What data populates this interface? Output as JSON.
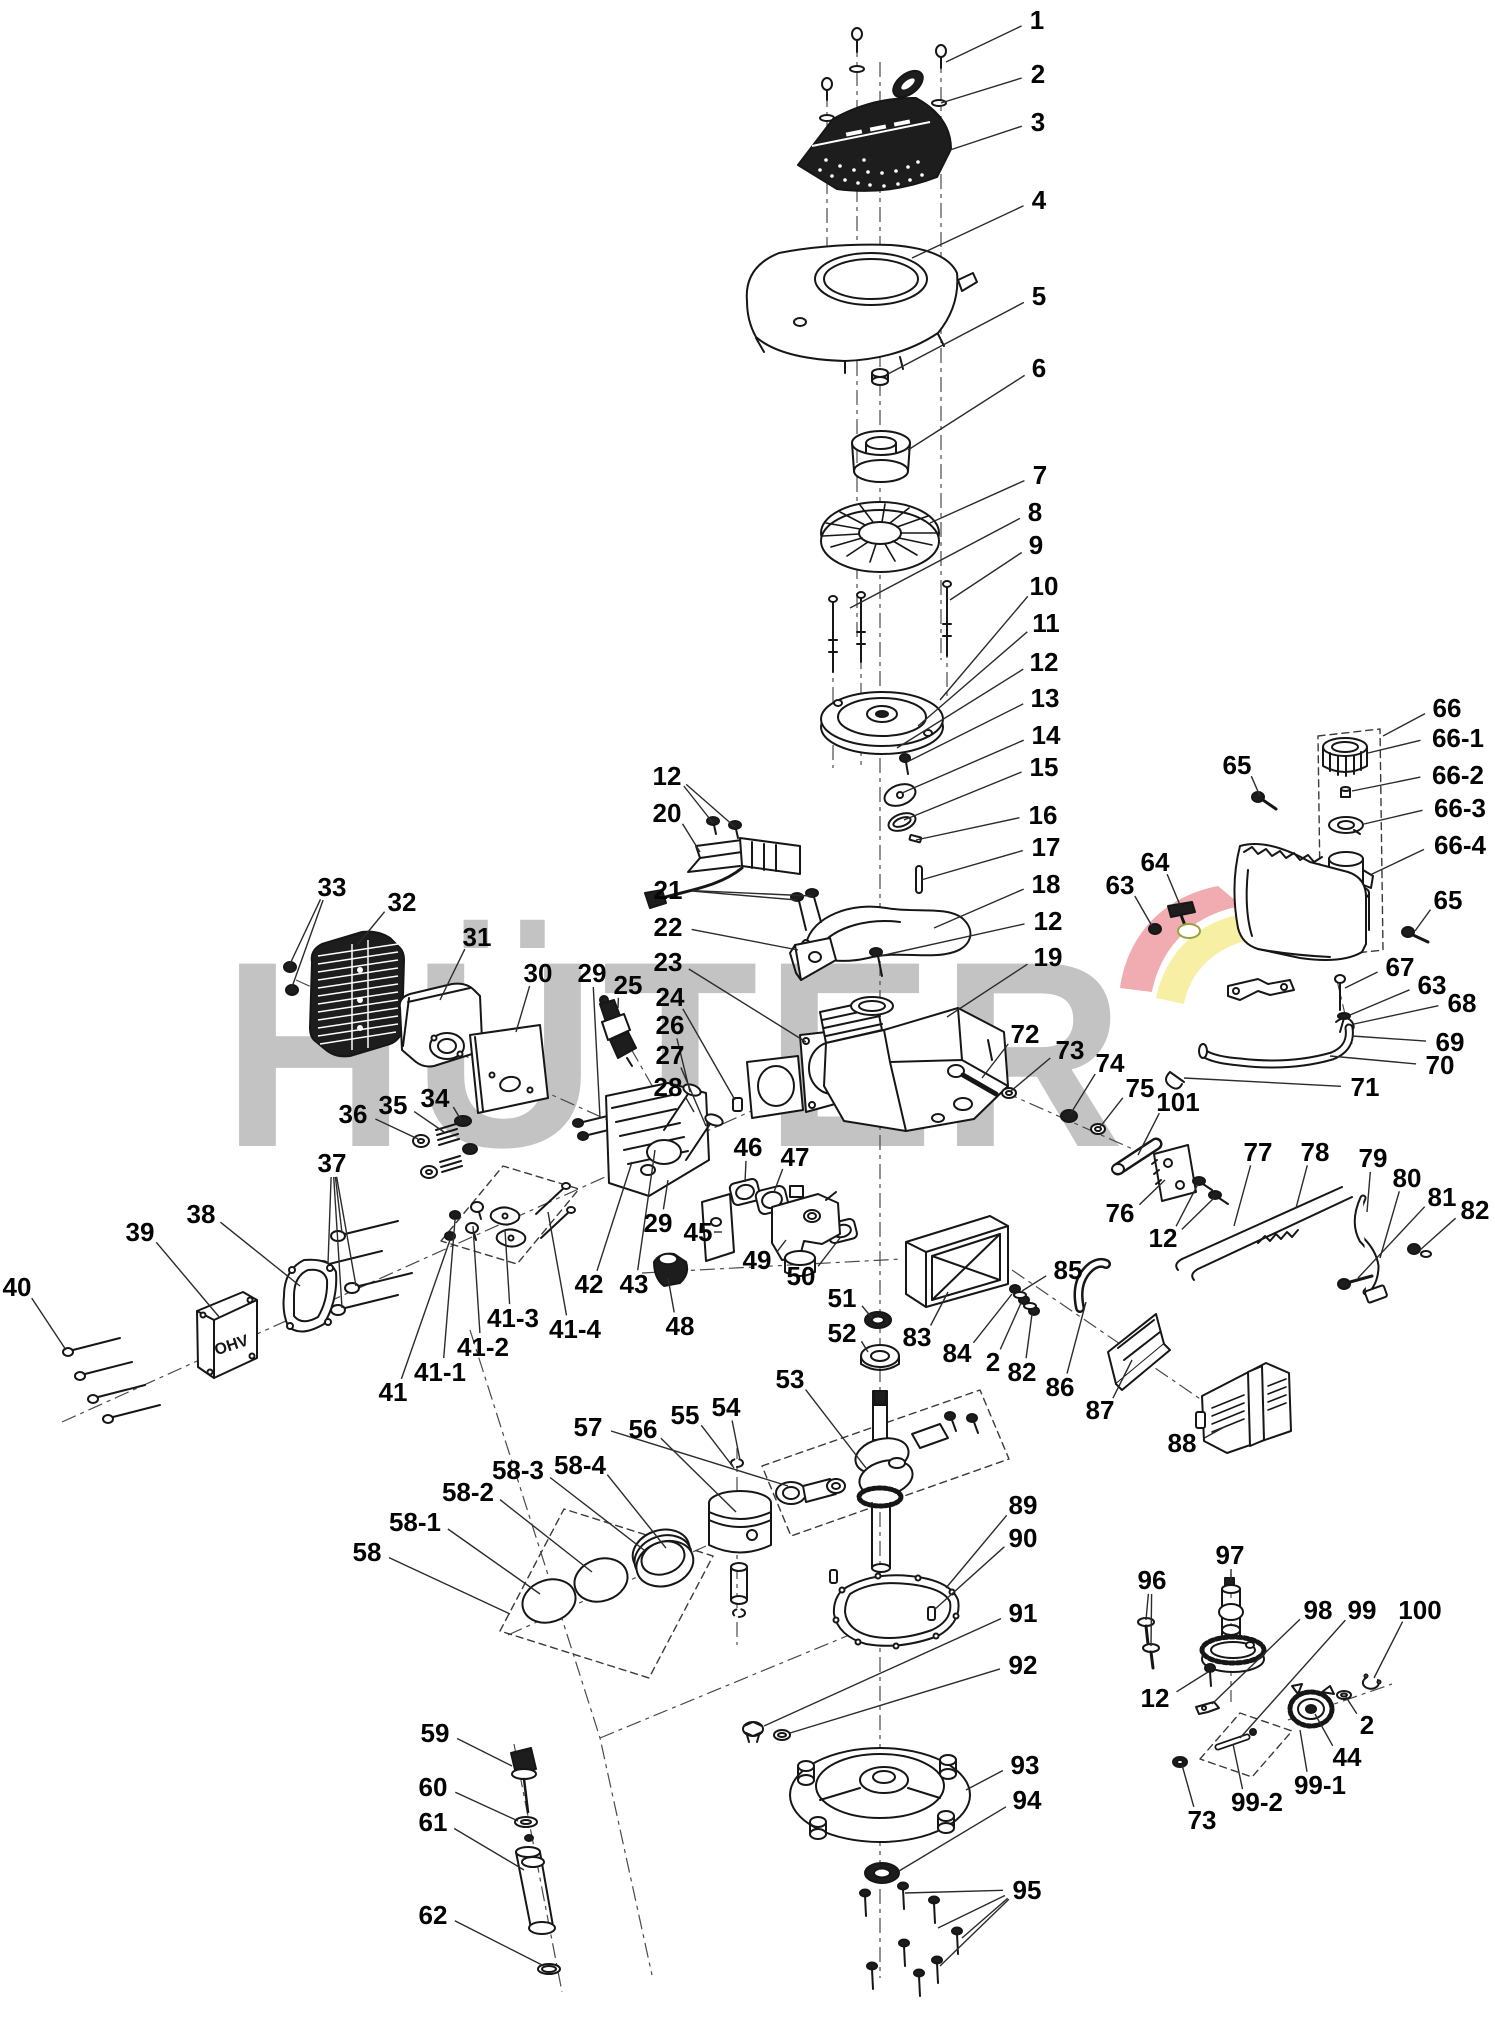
{
  "watermark": {
    "text": "HÜTER",
    "color": "#c3c3c3",
    "arc_pink": "#f0acb0",
    "arc_yellow": "#f7f0a4",
    "cover_text": "OHV"
  },
  "labels": [
    {
      "t": "1",
      "x": 1037,
      "y": 20,
      "g": [
        [
          946,
          62
        ]
      ]
    },
    {
      "t": "2",
      "x": 1038,
      "y": 74,
      "g": [
        [
          941,
          103
        ]
      ]
    },
    {
      "t": "3",
      "x": 1038,
      "y": 122,
      "g": [
        [
          950,
          150
        ]
      ]
    },
    {
      "t": "4",
      "x": 1039,
      "y": 200,
      "g": [
        [
          912,
          258
        ]
      ]
    },
    {
      "t": "5",
      "x": 1039,
      "y": 296,
      "g": [
        [
          888,
          374
        ]
      ]
    },
    {
      "t": "6",
      "x": 1039,
      "y": 368,
      "g": [
        [
          908,
          450
        ]
      ]
    },
    {
      "t": "7",
      "x": 1040,
      "y": 475,
      "g": [
        [
          930,
          523
        ]
      ]
    },
    {
      "t": "8",
      "x": 1035,
      "y": 512,
      "g": [
        [
          850,
          608
        ]
      ]
    },
    {
      "t": "9",
      "x": 1036,
      "y": 545,
      "g": [
        [
          950,
          600
        ]
      ]
    },
    {
      "t": "10",
      "x": 1044,
      "y": 586,
      "g": [
        [
          940,
          700
        ]
      ]
    },
    {
      "t": "11",
      "x": 1046,
      "y": 623,
      "g": [
        [
          918,
          726
        ]
      ]
    },
    {
      "t": "12",
      "x": 1044,
      "y": 662,
      "g": [
        [
          897,
          748
        ]
      ]
    },
    {
      "t": "13",
      "x": 1045,
      "y": 698,
      "g": [
        [
          907,
          762
        ]
      ]
    },
    {
      "t": "14",
      "x": 1046,
      "y": 735,
      "g": [
        [
          902,
          793
        ]
      ]
    },
    {
      "t": "15",
      "x": 1044,
      "y": 767,
      "g": [
        [
          904,
          820
        ]
      ]
    },
    {
      "t": "16",
      "x": 1043,
      "y": 815,
      "g": [
        [
          916,
          840
        ]
      ]
    },
    {
      "t": "17",
      "x": 1046,
      "y": 847,
      "g": [
        [
          921,
          880
        ]
      ]
    },
    {
      "t": "18",
      "x": 1046,
      "y": 884,
      "g": [
        [
          934,
          928
        ]
      ]
    },
    {
      "t": "12",
      "x": 1048,
      "y": 921,
      "g": [
        [
          880,
          956
        ]
      ]
    },
    {
      "t": "19",
      "x": 1048,
      "y": 957,
      "g": [
        [
          947,
          1017
        ]
      ]
    },
    {
      "t": "12",
      "x": 667,
      "y": 776,
      "g": [
        [
          713,
          823
        ],
        [
          735,
          827
        ]
      ]
    },
    {
      "t": "20",
      "x": 667,
      "y": 813,
      "g": [
        [
          700,
          852
        ]
      ]
    },
    {
      "t": "21",
      "x": 668,
      "y": 890,
      "g": [
        [
          797,
          900
        ],
        [
          812,
          896
        ]
      ]
    },
    {
      "t": "22",
      "x": 668,
      "y": 927,
      "g": [
        [
          798,
          950
        ]
      ]
    },
    {
      "t": "23",
      "x": 668,
      "y": 962,
      "g": [
        [
          806,
          1042
        ]
      ]
    },
    {
      "t": "24",
      "x": 670,
      "y": 997,
      "g": [
        [
          735,
          1100
        ]
      ]
    },
    {
      "t": "26",
      "x": 670,
      "y": 1025,
      "g": [
        [
          690,
          1092
        ]
      ]
    },
    {
      "t": "27",
      "x": 670,
      "y": 1055,
      "g": [
        [
          706,
          1126
        ]
      ]
    },
    {
      "t": "28",
      "x": 668,
      "y": 1087,
      "g": [
        [
          694,
          1112
        ]
      ]
    },
    {
      "t": "33",
      "x": 332,
      "y": 887,
      "g": [
        [
          290,
          964
        ],
        [
          292,
          987
        ]
      ]
    },
    {
      "t": "32",
      "x": 402,
      "y": 902,
      "g": [
        [
          358,
          944
        ]
      ]
    },
    {
      "t": "31",
      "x": 477,
      "y": 937,
      "g": [
        [
          440,
          1000
        ]
      ]
    },
    {
      "t": "30",
      "x": 538,
      "y": 973,
      "g": [
        [
          516,
          1032
        ]
      ]
    },
    {
      "t": "29",
      "x": 592,
      "y": 973,
      "g": [
        [
          600,
          1118
        ]
      ]
    },
    {
      "t": "25",
      "x": 628,
      "y": 985,
      "g": [
        [
          618,
          1008
        ]
      ]
    },
    {
      "t": "36",
      "x": 353,
      "y": 1114,
      "g": [
        [
          418,
          1139
        ]
      ]
    },
    {
      "t": "35",
      "x": 393,
      "y": 1105,
      "g": [
        [
          444,
          1132
        ]
      ]
    },
    {
      "t": "34",
      "x": 435,
      "y": 1098,
      "g": [
        [
          461,
          1120
        ]
      ]
    },
    {
      "t": "37",
      "x": 332,
      "y": 1163,
      "g": [
        [
          342,
          1233
        ],
        [
          328,
          1264
        ],
        [
          356,
          1286
        ],
        [
          342,
          1308
        ]
      ]
    },
    {
      "t": "38",
      "x": 201,
      "y": 1214,
      "g": [
        [
          300,
          1286
        ]
      ]
    },
    {
      "t": "39",
      "x": 140,
      "y": 1232,
      "g": [
        [
          220,
          1318
        ]
      ]
    },
    {
      "t": "40",
      "x": 17,
      "y": 1287,
      "g": [
        [
          66,
          1350
        ]
      ]
    },
    {
      "t": "41",
      "x": 393,
      "y": 1392,
      "g": [
        [
          450,
          1240
        ]
      ]
    },
    {
      "t": "41-1",
      "x": 440,
      "y": 1372,
      "g": [
        [
          455,
          1220
        ]
      ]
    },
    {
      "t": "41-2",
      "x": 483,
      "y": 1347,
      "g": [
        [
          473,
          1226
        ]
      ]
    },
    {
      "t": "41-3",
      "x": 513,
      "y": 1318,
      "g": [
        [
          505,
          1230
        ]
      ]
    },
    {
      "t": "41-4",
      "x": 575,
      "y": 1329,
      "g": [
        [
          548,
          1212
        ]
      ]
    },
    {
      "t": "42",
      "x": 589,
      "y": 1284,
      "g": [
        [
          632,
          1162
        ]
      ]
    },
    {
      "t": "43",
      "x": 634,
      "y": 1284,
      "g": [
        [
          655,
          1150
        ]
      ]
    },
    {
      "t": "29",
      "x": 658,
      "y": 1223,
      "g": [
        [
          668,
          1180
        ]
      ]
    },
    {
      "t": "45",
      "x": 698,
      "y": 1232,
      "g": [
        [
          714,
          1232
        ]
      ]
    },
    {
      "t": "46",
      "x": 748,
      "y": 1147,
      "g": [
        [
          745,
          1182
        ]
      ]
    },
    {
      "t": "47",
      "x": 795,
      "y": 1157,
      "g": [
        [
          774,
          1192
        ]
      ]
    },
    {
      "t": "48",
      "x": 680,
      "y": 1326,
      "g": [
        [
          668,
          1278
        ]
      ]
    },
    {
      "t": "49",
      "x": 757,
      "y": 1260,
      "g": [
        [
          786,
          1240
        ]
      ]
    },
    {
      "t": "50",
      "x": 801,
      "y": 1276,
      "g": [
        [
          840,
          1238
        ]
      ]
    },
    {
      "t": "51",
      "x": 842,
      "y": 1298,
      "g": [
        [
          872,
          1318
        ]
      ]
    },
    {
      "t": "52",
      "x": 842,
      "y": 1333,
      "g": [
        [
          868,
          1352
        ]
      ]
    },
    {
      "t": "53",
      "x": 790,
      "y": 1379,
      "g": [
        [
          866,
          1468
        ]
      ]
    },
    {
      "t": "83",
      "x": 917,
      "y": 1337,
      "g": [
        [
          948,
          1292
        ]
      ]
    },
    {
      "t": "84",
      "x": 957,
      "y": 1353,
      "g": [
        [
          1012,
          1294
        ]
      ]
    },
    {
      "t": "2",
      "x": 993,
      "y": 1362,
      "g": [
        [
          1021,
          1303
        ]
      ]
    },
    {
      "t": "82",
      "x": 1022,
      "y": 1372,
      "g": [
        [
          1032,
          1314
        ]
      ]
    },
    {
      "t": "85",
      "x": 1068,
      "y": 1270,
      "g": [
        [
          1022,
          1291
        ]
      ]
    },
    {
      "t": "86",
      "x": 1060,
      "y": 1387,
      "g": [
        [
          1086,
          1302
        ]
      ]
    },
    {
      "t": "87",
      "x": 1100,
      "y": 1410,
      "g": [
        [
          1132,
          1360
        ]
      ]
    },
    {
      "t": "88",
      "x": 1182,
      "y": 1443,
      "g": [
        [
          1226,
          1426
        ]
      ]
    },
    {
      "t": "72",
      "x": 1025,
      "y": 1034,
      "g": [
        [
          982,
          1078
        ]
      ]
    },
    {
      "t": "73",
      "x": 1070,
      "y": 1050,
      "g": [
        [
          1011,
          1091
        ]
      ]
    },
    {
      "t": "74",
      "x": 1110,
      "y": 1063,
      "g": [
        [
          1071,
          1113
        ]
      ]
    },
    {
      "t": "75",
      "x": 1140,
      "y": 1088,
      "g": [
        [
          1100,
          1127
        ]
      ]
    },
    {
      "t": "101",
      "x": 1178,
      "y": 1102,
      "g": [
        [
          1138,
          1155
        ]
      ]
    },
    {
      "t": "76",
      "x": 1120,
      "y": 1213,
      "g": [
        [
          1165,
          1180
        ]
      ]
    },
    {
      "t": "12",
      "x": 1163,
      "y": 1238,
      "g": [
        [
          1198,
          1184
        ],
        [
          1214,
          1198
        ]
      ]
    },
    {
      "t": "77",
      "x": 1258,
      "y": 1152,
      "g": [
        [
          1234,
          1226
        ]
      ]
    },
    {
      "t": "78",
      "x": 1315,
      "y": 1152,
      "g": [
        [
          1296,
          1208
        ]
      ]
    },
    {
      "t": "79",
      "x": 1373,
      "y": 1158,
      "g": [
        [
          1367,
          1212
        ]
      ]
    },
    {
      "t": "80",
      "x": 1407,
      "y": 1178,
      "g": [
        [
          1380,
          1258
        ]
      ]
    },
    {
      "t": "81",
      "x": 1442,
      "y": 1197,
      "g": [
        [
          1358,
          1278
        ]
      ]
    },
    {
      "t": "82",
      "x": 1475,
      "y": 1210,
      "g": [
        [
          1420,
          1250
        ]
      ]
    },
    {
      "t": "63",
      "x": 1120,
      "y": 885,
      "g": [
        [
          1152,
          926
        ]
      ]
    },
    {
      "t": "64",
      "x": 1155,
      "y": 862,
      "g": [
        [
          1180,
          905
        ]
      ]
    },
    {
      "t": "65",
      "x": 1237,
      "y": 765,
      "g": [
        [
          1260,
          796
        ]
      ]
    },
    {
      "t": "66",
      "x": 1447,
      "y": 708,
      "g": [
        [
          1383,
          736
        ]
      ]
    },
    {
      "t": "66-1",
      "x": 1458,
      "y": 738,
      "g": [
        [
          1368,
          753
        ]
      ]
    },
    {
      "t": "66-2",
      "x": 1458,
      "y": 775,
      "g": [
        [
          1352,
          791
        ]
      ]
    },
    {
      "t": "66-3",
      "x": 1460,
      "y": 808,
      "g": [
        [
          1364,
          824
        ]
      ]
    },
    {
      "t": "66-4",
      "x": 1460,
      "y": 845,
      "g": [
        [
          1370,
          875
        ]
      ]
    },
    {
      "t": "65",
      "x": 1448,
      "y": 900,
      "g": [
        [
          1415,
          931
        ]
      ]
    },
    {
      "t": "67",
      "x": 1400,
      "y": 967,
      "g": [
        [
          1345,
          988
        ]
      ]
    },
    {
      "t": "63",
      "x": 1432,
      "y": 985,
      "g": [
        [
          1350,
          1015
        ]
      ]
    },
    {
      "t": "68",
      "x": 1462,
      "y": 1003,
      "g": [
        [
          1354,
          1024
        ]
      ]
    },
    {
      "t": "69",
      "x": 1450,
      "y": 1042,
      "g": [
        [
          1352,
          1036
        ]
      ]
    },
    {
      "t": "70",
      "x": 1440,
      "y": 1065,
      "g": [
        [
          1330,
          1056
        ]
      ]
    },
    {
      "t": "71",
      "x": 1365,
      "y": 1087,
      "g": [
        [
          1184,
          1078
        ]
      ]
    },
    {
      "t": "89",
      "x": 1023,
      "y": 1505,
      "g": [
        [
          946,
          1588
        ]
      ]
    },
    {
      "t": "90",
      "x": 1023,
      "y": 1538,
      "g": [
        [
          934,
          1610
        ]
      ]
    },
    {
      "t": "91",
      "x": 1023,
      "y": 1613,
      "g": [
        [
          764,
          1726
        ]
      ]
    },
    {
      "t": "92",
      "x": 1023,
      "y": 1665,
      "g": [
        [
          790,
          1733
        ]
      ]
    },
    {
      "t": "93",
      "x": 1025,
      "y": 1765,
      "g": [
        [
          966,
          1790
        ]
      ]
    },
    {
      "t": "94",
      "x": 1027,
      "y": 1800,
      "g": [
        [
          899,
          1871
        ]
      ]
    },
    {
      "t": "95",
      "x": 1027,
      "y": 1890,
      "g": [
        [
          905,
          1893
        ],
        [
          938,
          1928
        ],
        [
          962,
          1938
        ],
        [
          940,
          1966
        ]
      ]
    },
    {
      "t": "96",
      "x": 1152,
      "y": 1580,
      "g": [
        [
          1146,
          1620
        ],
        [
          1151,
          1646
        ]
      ]
    },
    {
      "t": "97",
      "x": 1230,
      "y": 1555,
      "g": [
        [
          1231,
          1580
        ]
      ]
    },
    {
      "t": "98",
      "x": 1318,
      "y": 1610,
      "g": [
        [
          1212,
          1704
        ]
      ]
    },
    {
      "t": "99",
      "x": 1362,
      "y": 1610,
      "g": [
        [
          1240,
          1738
        ]
      ]
    },
    {
      "t": "100",
      "x": 1420,
      "y": 1610,
      "g": [
        [
          1374,
          1678
        ]
      ]
    },
    {
      "t": "12",
      "x": 1155,
      "y": 1698,
      "g": [
        [
          1208,
          1672
        ]
      ]
    },
    {
      "t": "2",
      "x": 1367,
      "y": 1725,
      "g": [
        [
          1346,
          1697
        ]
      ]
    },
    {
      "t": "44",
      "x": 1347,
      "y": 1757,
      "g": [
        [
          1315,
          1714
        ]
      ]
    },
    {
      "t": "99-1",
      "x": 1320,
      "y": 1785,
      "g": [
        [
          1300,
          1730
        ]
      ]
    },
    {
      "t": "99-2",
      "x": 1257,
      "y": 1802,
      "g": [
        [
          1233,
          1744
        ]
      ]
    },
    {
      "t": "73",
      "x": 1202,
      "y": 1820,
      "g": [
        [
          1182,
          1765
        ]
      ]
    },
    {
      "t": "59",
      "x": 435,
      "y": 1733,
      "g": [
        [
          512,
          1766
        ]
      ]
    },
    {
      "t": "60",
      "x": 433,
      "y": 1787,
      "g": [
        [
          518,
          1821
        ]
      ]
    },
    {
      "t": "61",
      "x": 433,
      "y": 1822,
      "g": [
        [
          524,
          1870
        ]
      ]
    },
    {
      "t": "62",
      "x": 433,
      "y": 1915,
      "g": [
        [
          544,
          1966
        ]
      ]
    },
    {
      "t": "58",
      "x": 367,
      "y": 1552,
      "g": [
        [
          510,
          1614
        ]
      ]
    },
    {
      "t": "58-1",
      "x": 415,
      "y": 1522,
      "g": [
        [
          540,
          1594
        ]
      ]
    },
    {
      "t": "58-2",
      "x": 468,
      "y": 1492,
      "g": [
        [
          592,
          1572
        ]
      ]
    },
    {
      "t": "58-3",
      "x": 518,
      "y": 1470,
      "g": [
        [
          644,
          1550
        ]
      ]
    },
    {
      "t": "58-4",
      "x": 580,
      "y": 1465,
      "g": [
        [
          666,
          1548
        ]
      ]
    },
    {
      "t": "57",
      "x": 588,
      "y": 1427,
      "g": [
        [
          788,
          1486
        ]
      ]
    },
    {
      "t": "56",
      "x": 643,
      "y": 1429,
      "g": [
        [
          736,
          1512
        ]
      ]
    },
    {
      "t": "55",
      "x": 685,
      "y": 1415,
      "g": [
        [
          734,
          1468
        ]
      ]
    },
    {
      "t": "54",
      "x": 726,
      "y": 1407,
      "g": [
        [
          740,
          1460
        ]
      ]
    }
  ]
}
